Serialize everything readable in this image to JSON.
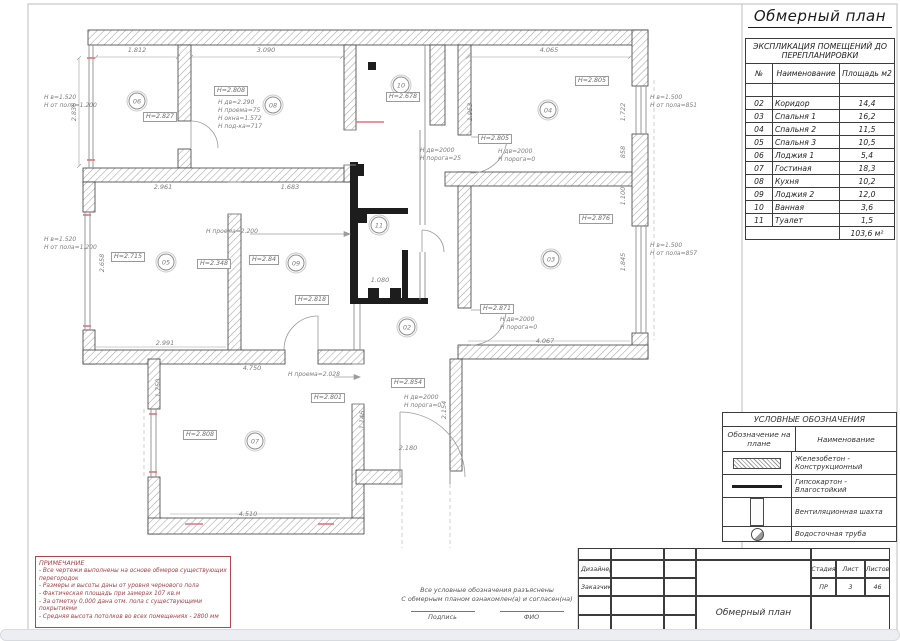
{
  "sheet": {
    "title": "Обмерный план"
  },
  "explication": {
    "title": "ЭКСПЛИКАЦИЯ ПОМЕЩЕНИЙ ДО ПЕРЕПЛАНИРОВКИ",
    "columns": [
      "№",
      "Наименование",
      "Площадь м2"
    ],
    "rows": [
      {
        "num": "",
        "name": "",
        "area": ""
      },
      {
        "num": "02",
        "name": "Коридор",
        "area": "14,4"
      },
      {
        "num": "03",
        "name": "Спальня 1",
        "area": "16,2"
      },
      {
        "num": "04",
        "name": "Спальня 2",
        "area": "11,5"
      },
      {
        "num": "05",
        "name": "Спальня 3",
        "area": "10,5"
      },
      {
        "num": "06",
        "name": "Лоджия 1",
        "area": "5,4"
      },
      {
        "num": "07",
        "name": "Гостиная",
        "area": "18,3"
      },
      {
        "num": "08",
        "name": "Кухня",
        "area": "10,2"
      },
      {
        "num": "09",
        "name": "Лоджия 2",
        "area": "12,0"
      },
      {
        "num": "10",
        "name": "Ванная",
        "area": "3,6"
      },
      {
        "num": "11",
        "name": "Туалет",
        "area": "1,5"
      }
    ],
    "total": "103,6 м²"
  },
  "legend": {
    "title": "УСЛОВНЫЕ ОБОЗНАЧЕНИЯ",
    "col1": "Обозначение на плане",
    "col2": "Наименование",
    "rows": [
      {
        "symbol": "concrete-hatch",
        "label": "Железобетон -\nКонструкционный"
      },
      {
        "symbol": "thick-line",
        "label": "Гипсокартон -\nВлагостойкий"
      },
      {
        "symbol": "vent-shaft",
        "label": "Вентиляционная шахта"
      },
      {
        "symbol": "drain-pipe",
        "label": "Водосточная труба"
      }
    ]
  },
  "note": {
    "title": "ПРИМЕЧАНИЕ",
    "lines": [
      "- Все чертежи выполнены на основе обмеров существующих перегородок",
      "- Размеры и высоты даны от уровня чернового пола",
      "- Фактическая площадь при замерах 107 кв.м",
      "- За отметку 0,000 дана отм. пола с существующими покрытиями",
      "- Средняя высота потолков во всех помещениях - 2800 мм"
    ]
  },
  "signature": {
    "line1": "Все условные обозначения разъяснены",
    "line2": "С обмерным планом ознакомлен(а) и согласен(на)",
    "sign_label": "Подпись",
    "name_label": "ФИО"
  },
  "titleblock": {
    "designer_label": "Дизайнер",
    "customer_label": "Заказчик",
    "doc_title": "Обмерный план",
    "stage_label": "Стадия",
    "sheet_label": "Лист",
    "sheets_label": "Листов",
    "stage": "ПР",
    "sheet": "3",
    "sheets": "46"
  },
  "plan": {
    "rooms": [
      {
        "num": "06",
        "x": 137,
        "y": 101
      },
      {
        "num": "08",
        "x": 273,
        "y": 105
      },
      {
        "num": "10",
        "x": 401,
        "y": 85
      },
      {
        "num": "04",
        "x": 548,
        "y": 110
      },
      {
        "num": "05",
        "x": 166,
        "y": 262
      },
      {
        "num": "09",
        "x": 296,
        "y": 263
      },
      {
        "num": "03",
        "x": 551,
        "y": 259
      },
      {
        "num": "11",
        "x": 379,
        "y": 225
      },
      {
        "num": "02",
        "x": 407,
        "y": 327
      },
      {
        "num": "07",
        "x": 255,
        "y": 441
      }
    ],
    "boxed": [
      {
        "t": "H=2.827",
        "x": 160,
        "y": 117
      },
      {
        "t": "H=2.808",
        "x": 231,
        "y": 91
      },
      {
        "t": "H=2.678",
        "x": 403,
        "y": 97
      },
      {
        "t": "H=2.805",
        "x": 592,
        "y": 81
      },
      {
        "t": "H=2.805",
        "x": 495,
        "y": 139
      },
      {
        "t": "H=2.876",
        "x": 596,
        "y": 219
      },
      {
        "t": "H=2.871",
        "x": 497,
        "y": 309
      },
      {
        "t": "H=2.715",
        "x": 128,
        "y": 257
      },
      {
        "t": "H=2.348",
        "x": 214,
        "y": 264
      },
      {
        "t": "H=2.84",
        "x": 264,
        "y": 260
      },
      {
        "t": "H=2.818",
        "x": 312,
        "y": 300
      },
      {
        "t": "H=2.808",
        "x": 200,
        "y": 435
      },
      {
        "t": "H=2.801",
        "x": 328,
        "y": 398
      },
      {
        "t": "H=2.854",
        "x": 408,
        "y": 383
      }
    ],
    "dims": [
      {
        "t": "1.812",
        "x": 137,
        "y": 50
      },
      {
        "t": "3.090",
        "x": 266,
        "y": 50
      },
      {
        "t": "4.065",
        "x": 549,
        "y": 50
      },
      {
        "t": "2.836",
        "x": 74,
        "y": 112,
        "r": 1
      },
      {
        "t": "2.961",
        "x": 163,
        "y": 187
      },
      {
        "t": "1.683",
        "x": 290,
        "y": 187
      },
      {
        "t": "2.658",
        "x": 102,
        "y": 263,
        "r": 1
      },
      {
        "t": "2.991",
        "x": 165,
        "y": 343
      },
      {
        "t": "4.067",
        "x": 545,
        "y": 341
      },
      {
        "t": "4.750",
        "x": 252,
        "y": 368
      },
      {
        "t": "4.510",
        "x": 248,
        "y": 514
      },
      {
        "t": "1.750",
        "x": 158,
        "y": 388,
        "r": 1
      },
      {
        "t": "2.180",
        "x": 408,
        "y": 448
      },
      {
        "t": "2.154",
        "x": 444,
        "y": 410,
        "r": 1
      },
      {
        "t": "1.146",
        "x": 362,
        "y": 420,
        "r": 1
      },
      {
        "t": "1.953",
        "x": 470,
        "y": 112,
        "r": 1
      },
      {
        "t": "1.722",
        "x": 623,
        "y": 112,
        "r": 1
      },
      {
        "t": "858",
        "x": 623,
        "y": 152,
        "r": 1
      },
      {
        "t": "1.100",
        "x": 623,
        "y": 196,
        "r": 1
      },
      {
        "t": "1.845",
        "x": 623,
        "y": 262,
        "r": 1
      },
      {
        "t": "1.080",
        "x": 380,
        "y": 280
      }
    ],
    "annos": [
      {
        "x": 44,
        "y": 94,
        "lines": [
          "H в=1.520",
          "H от пола=1.200"
        ]
      },
      {
        "x": 44,
        "y": 236,
        "lines": [
          "H в=1.520",
          "H от пола=1.200"
        ]
      },
      {
        "x": 650,
        "y": 94,
        "lines": [
          "H в=1.500",
          "H от пола=851"
        ]
      },
      {
        "x": 650,
        "y": 242,
        "lines": [
          "H в=1.500",
          "H от пола=857"
        ]
      },
      {
        "x": 218,
        "y": 99,
        "lines": [
          "H дв=2.290",
          "H проема=75",
          "H окна=1.572",
          "H под-ка=717"
        ]
      },
      {
        "x": 420,
        "y": 147,
        "lines": [
          "H дв=2000",
          "H порога=25"
        ]
      },
      {
        "x": 498,
        "y": 148,
        "lines": [
          "H дв=2000",
          "H порога=0"
        ]
      },
      {
        "x": 500,
        "y": 316,
        "lines": [
          "H дв=2000",
          "H порога=0"
        ]
      },
      {
        "x": 404,
        "y": 394,
        "lines": [
          "H дв=2000",
          "H порога=0"
        ]
      },
      {
        "x": 206,
        "y": 228,
        "lines": [
          "H проема=2.200"
        ]
      },
      {
        "x": 288,
        "y": 371,
        "lines": [
          "H проема=2.028"
        ]
      }
    ]
  }
}
